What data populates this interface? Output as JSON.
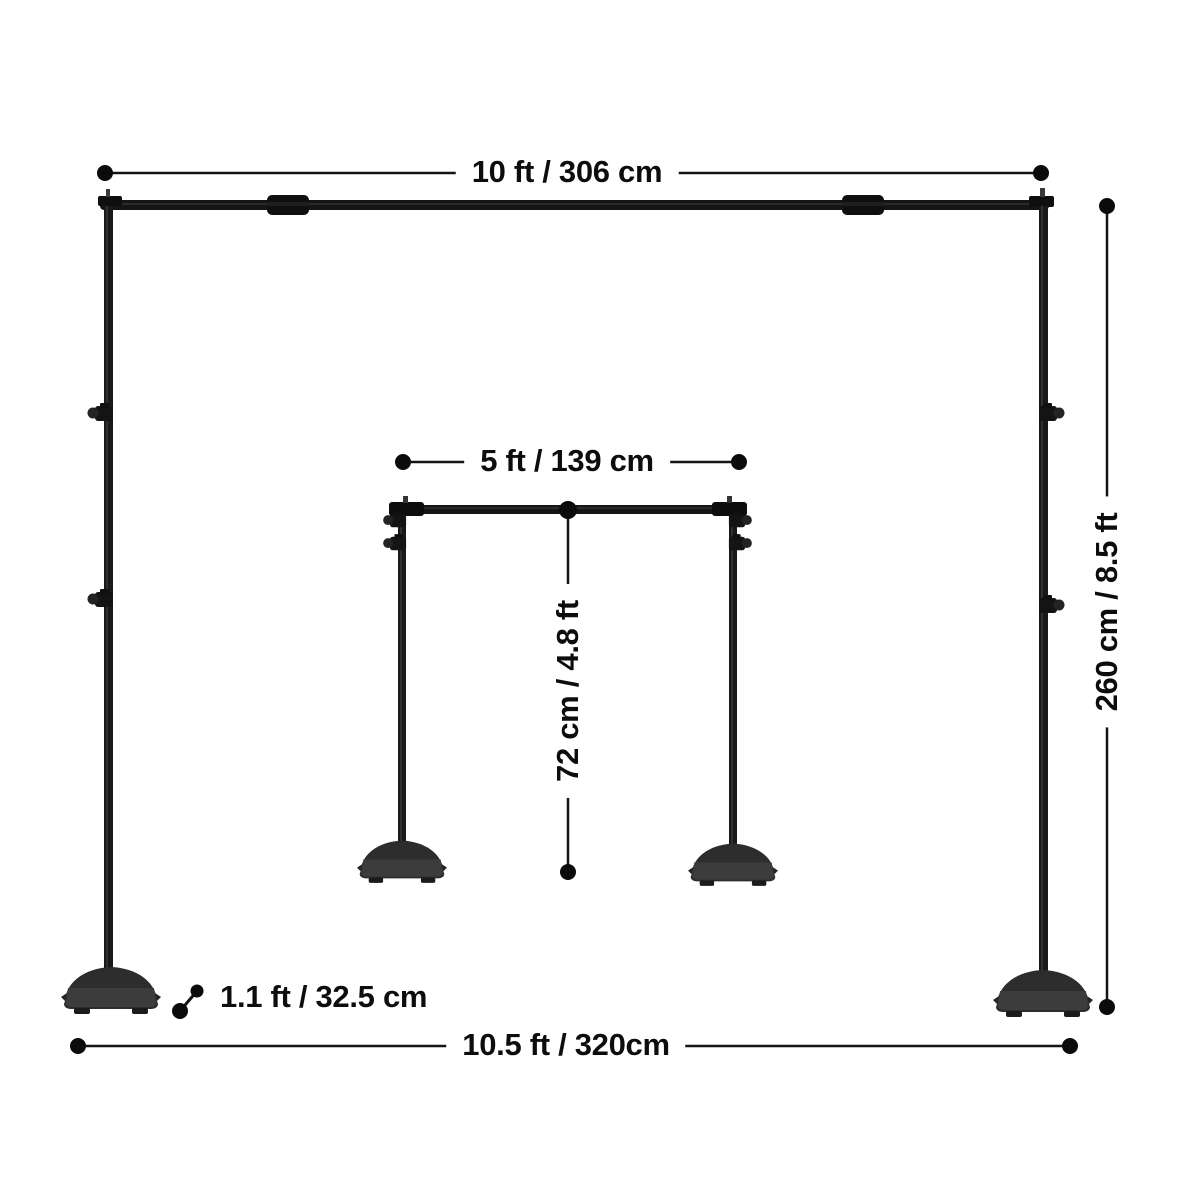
{
  "diagram_title": "backdrop-stand-dimensions",
  "labels": {
    "top_width": "10 ft / 306 cm",
    "inner_width": "5 ft / 139 cm",
    "inner_height": "72 cm / 4.8 ft",
    "stand_height": "260 cm / 8.5 ft",
    "base_length": "1.1 ft / 32.5 cm",
    "footprint_width": "10.5 ft / 320cm"
  },
  "colors": {
    "background": "#ffffff",
    "dimension_line": "#141414",
    "dot": "#0b0b0b",
    "text": "#0d0d0d",
    "pole_dark": "#161616",
    "pole_mid": "#1e1e1e",
    "base_dark": "#2d2d2d",
    "base_mid": "#3c3c3c",
    "fitting": "#0f0f0f"
  }
}
